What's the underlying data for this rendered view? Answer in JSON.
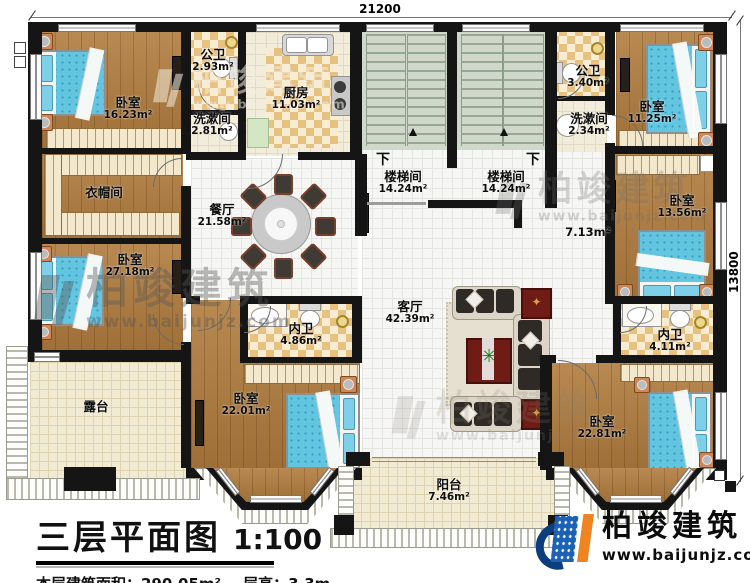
{
  "dimensions": {
    "top": "21200",
    "right": "13800"
  },
  "rooms": {
    "bedroom_tl": {
      "name": "卧室",
      "area": "16.23m²"
    },
    "bath_l": {
      "name": "公卫",
      "area": "2.93m²"
    },
    "wash_l": {
      "name": "洗漱间",
      "area": "2.81m²"
    },
    "kitchen": {
      "name": "厨房",
      "area": "11.03m²"
    },
    "cloakroom": {
      "name": "衣帽间"
    },
    "dining": {
      "name": "餐厅",
      "area": "21.58m²"
    },
    "bedroom_ml": {
      "name": "卧室",
      "area": "27.18m²"
    },
    "terrace": {
      "name": "露台"
    },
    "stair_l": {
      "name": "楼梯间",
      "area": "14.24m²"
    },
    "stair_r": {
      "name": "楼梯间",
      "area": "14.24m²"
    },
    "down_l": {
      "name": "下"
    },
    "down_r": {
      "name": "下"
    },
    "bath_r": {
      "name": "公卫",
      "area": "3.40m²"
    },
    "wash_r": {
      "name": "洗漱间",
      "area": "2.34m²"
    },
    "bedroom_tr": {
      "name": "卧室",
      "area": "11.25m²"
    },
    "bedroom_mr": {
      "name": "卧室",
      "area": "13.56m²"
    },
    "hall": {
      "area": "7.13m²"
    },
    "bath_c": {
      "name": "内卫",
      "area": "4.86m²"
    },
    "bath_br": {
      "name": "内卫",
      "area": "4.11m²"
    },
    "living": {
      "name": "客厅",
      "area": "42.39m²"
    },
    "bedroom_bl": {
      "name": "卧室",
      "area": "22.01m²"
    },
    "bedroom_br": {
      "name": "卧室",
      "area": "22.81m²"
    },
    "balcony": {
      "name": "阳台",
      "area": "7.46m²"
    }
  },
  "title": {
    "main": "三层平面图",
    "scale": "1:100",
    "area_label": "本层建筑面积：290.05m²",
    "height_label": "层高：3.3m"
  },
  "brand": {
    "name": "柏竣建筑",
    "url": "www.baijunjz.com"
  },
  "watermark": {
    "name": "柏竣建筑",
    "url": "www.baijunjz.com"
  }
}
